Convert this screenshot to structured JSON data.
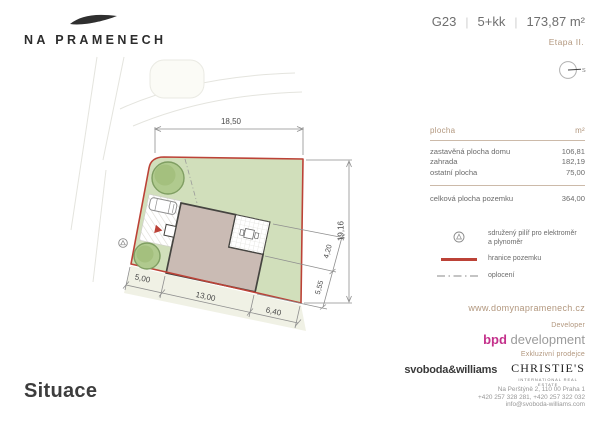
{
  "brand": {
    "logo_text": "NA PRAMENECH"
  },
  "header": {
    "unit": "G23",
    "layout": "5+kk",
    "area": "173,87 m²",
    "sep": "|",
    "stage": "Etapa II."
  },
  "compass": {
    "north_label": "S"
  },
  "areas_table": {
    "col_label": "plocha",
    "col_unit": "m²",
    "rows": [
      {
        "label": "zastavěná plocha domu",
        "value": "106,81"
      },
      {
        "label": "zahrada",
        "value": "182,19"
      },
      {
        "label": "ostatní plocha",
        "value": "75,00"
      }
    ],
    "total": {
      "label": "celková plocha pozemku",
      "value": "364,00"
    }
  },
  "legend": {
    "items": [
      {
        "icon": "utility-pillar-icon",
        "line1": "sdružený pilíř pro elektroměr",
        "line2": "a plynoměr"
      },
      {
        "icon": "plot-boundary-line",
        "line1": "hranice pozemku",
        "line2": ""
      },
      {
        "icon": "fence-dash-dot-line",
        "line1": "oplocení",
        "line2": ""
      }
    ]
  },
  "website": "www.domynapramenech.cz",
  "developer": {
    "heading": "Developer",
    "name_accent": "bpd",
    "name_rest": "development"
  },
  "broker": {
    "heading": "Exkluzivní prodejce",
    "agency1": "svoboda&williams",
    "agency2": "CHRISTIE'S",
    "agency2_sub": "INTERNATIONAL REAL ESTATE",
    "address_lines": [
      "Na Perštýně 2, 110 00 Praha 1",
      "+420 257 328 281, +420 257 322 032",
      "info@svoboda-williams.com"
    ]
  },
  "page_title": "Situace",
  "plan": {
    "dimensions": {
      "top": "18,50",
      "right": "19,16",
      "terrace_side": "4,20",
      "house_side": "5,55",
      "front_left": "5,00",
      "house_width": "13,00",
      "front_right": "6,40"
    },
    "colors": {
      "plot_green": "#d1dfbb",
      "boundary_red": "#bc4237",
      "house_mauve": "#cabbb4",
      "tree_green": "#b0ca8e",
      "accent_tan": "#b2977e",
      "developer_magenta": "#c4318b"
    }
  }
}
